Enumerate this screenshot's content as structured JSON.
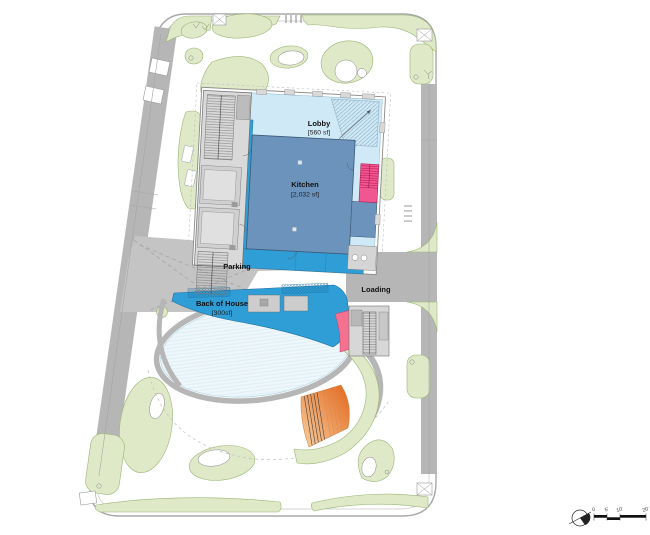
{
  "rooms": {
    "lobby": {
      "name": "Lobby",
      "area": "[560 sf]"
    },
    "kitchen": {
      "name": "Kitchen",
      "area": "[2,032 sf]"
    },
    "parking": {
      "name": "Parking"
    },
    "loading": {
      "name": "Loading"
    },
    "back_of_house": {
      "name": "Back of House",
      "area": "[300sf]"
    }
  },
  "scale_bar": {
    "labels": [
      "0",
      "5'",
      "10'",
      "20'"
    ]
  },
  "colors": {
    "lobby_fill": "#cfe9f6",
    "kitchen_fill": "#6b93bb",
    "circulation_blue": "#2f9ed6",
    "stair_pink": "#f0568f",
    "wedge_pink": "#f4718f",
    "landscape_green": "#dfe9c8",
    "landscape_edge": "#9ab575",
    "road_gray": "#b6b6b6",
    "core_gray": "#d9d9d9",
    "pool_fill": "#eef7fb",
    "ramp_orange": "#e2671c"
  }
}
